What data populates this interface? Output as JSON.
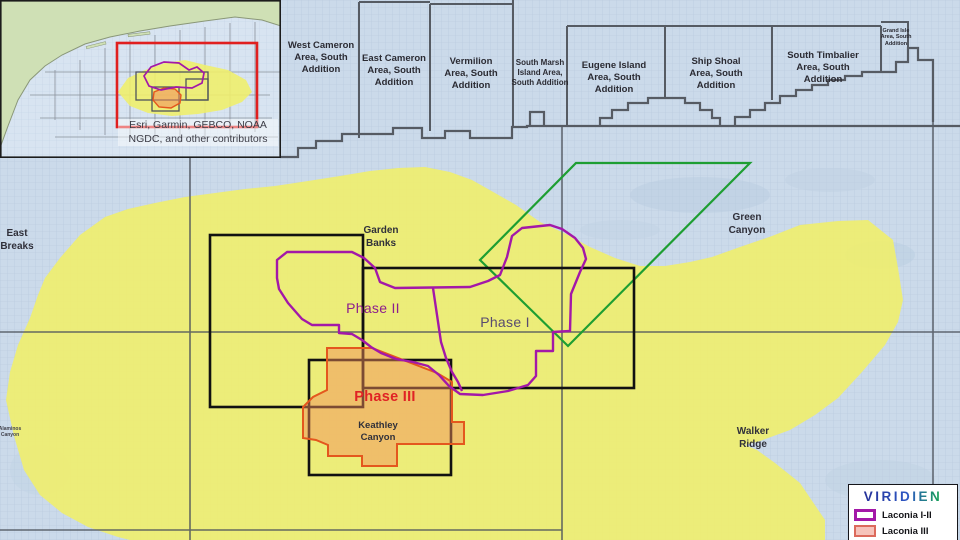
{
  "colors": {
    "purple": "#A318A8",
    "orange": "#E4571E",
    "orange_fill": "#F28C5A",
    "green": "#1E9E32",
    "yellow": "#F0EE6D",
    "red": "#E01F1F",
    "water": "#CBDAEA",
    "land": "#CFE0B5",
    "phase1_text": "#584A70",
    "phase2_text": "#8D1D8D",
    "phase3_text": "#E02325",
    "brand_a": "#23278E",
    "brand_b": "#2E58C4",
    "brand_c": "#17A254",
    "brand_d": "#38B44A"
  },
  "shelf": {
    "areas": [
      {
        "name": "West Cameron Area, South Addition"
      },
      {
        "name": "East Cameron Area, South Addition"
      },
      {
        "name": "Vermilion Area, South Addition"
      },
      {
        "name": "South Marsh Island Area, South Addition"
      },
      {
        "name": "Eugene Island Area, South Addition"
      },
      {
        "name": "Ship Shoal Area, South Addition"
      },
      {
        "name": "South Timbalier Area, South Addition"
      },
      {
        "name": "Grand Isle Area, South Addition"
      }
    ]
  },
  "map_labels": {
    "east_breaks": "East Breaks",
    "garden_banks": "Garden Banks",
    "green_canyon": "Green Canyon",
    "walker_ridge": "Walker Ridge",
    "keathley_canyon": "Keathley Canyon",
    "alaminos_canyon": "Alaminos Canyon"
  },
  "phases": {
    "phase1": "Phase I",
    "phase2": "Phase II",
    "phase3": "Phase III"
  },
  "inset": {
    "attribution_line1": "Esri, Garmin, GEBCO, NOAA",
    "attribution_line2": "NGDC, and other contributors"
  },
  "legend": {
    "brand": "VIRIDIEN",
    "items": [
      {
        "label": "Laconia I-II"
      },
      {
        "label": "Laconia III"
      }
    ]
  }
}
